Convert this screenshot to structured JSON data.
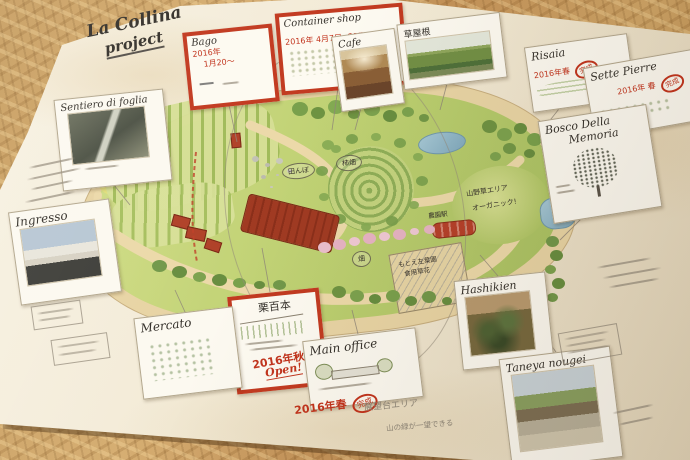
{
  "title": {
    "line1": "La Collina",
    "line2": "project"
  },
  "boxes": {
    "bago": {
      "label": "Bago",
      "date": "2016年",
      "date2": "1月20～"
    },
    "container": {
      "label": "Container shop",
      "date": "2016年 4月7日",
      "status": "OPEN!"
    },
    "kuri": {
      "label": "栗百本",
      "date": "2016年秋",
      "status": "Open!"
    }
  },
  "cards": {
    "cafe": {
      "label": "Cafe"
    },
    "kusayane": {
      "label": "草屋根"
    },
    "risaia": {
      "label": "Risaia",
      "date": "2016年春",
      "stamp": "完成"
    },
    "sette": {
      "label": "Sette Pierre",
      "date": "2016年 春",
      "stamp": "完成"
    },
    "bosco": {
      "label1": "Bosco Della",
      "label2": "Memoria"
    },
    "sentiero": {
      "label": "Sentiero di foglia"
    },
    "ingresso": {
      "label": "Ingresso"
    },
    "mercato": {
      "label": "Mercato"
    },
    "office": {
      "label": "Main office",
      "date": "2016年春",
      "stamp": "完成"
    },
    "hashikien": {
      "label": "Hashikien"
    },
    "taneya": {
      "label": "Taneya nougei"
    }
  },
  "map_labels": {
    "tanbo": "田んぼ",
    "kakibatake": "柿畑",
    "hatake": "畑",
    "sanyaso": "山野草エリア",
    "organic": "オーガニック!",
    "sayoen1": "もとえ左葉園",
    "sayoen2": "食用草花",
    "station": "農園駅"
  },
  "notes": {
    "viewpoint1": "展望台エリア",
    "viewpoint2": "山の緑が一望できる"
  },
  "colors": {
    "marker_red": "#c23a20",
    "paper": "#f1e8d2",
    "wood": "#c89e60",
    "map_green": "#bccf70",
    "pond_blue": "#8fb6c9"
  }
}
